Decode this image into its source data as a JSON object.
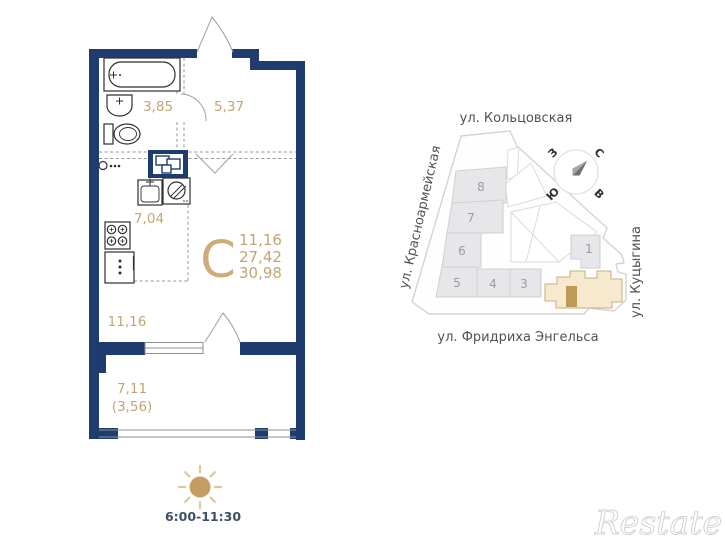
{
  "floor_plan": {
    "unit_letter": "С",
    "stats": [
      "11,16",
      "27,42",
      "30,98"
    ],
    "labels": {
      "bathroom": "3,85",
      "hall": "5,37",
      "kitchen": "7,04",
      "living": "11,16",
      "balcony": "7,11",
      "balcony_reduced": "(3,56)"
    }
  },
  "site_plan": {
    "streets": {
      "top": "ул. Кольцовская",
      "left": "ул. Красноармейская",
      "right": "ул. Куцыгина",
      "bottom": "ул. Фридриха Энгельса"
    },
    "compass": {
      "north": "С",
      "south": "Ю",
      "west": "З",
      "east": "В"
    },
    "building_numbers": [
      "8",
      "7",
      "6",
      "5",
      "4",
      "3",
      "1"
    ]
  },
  "insolation": {
    "time_range": "6:00-11:30"
  },
  "watermark": {
    "text": "Restate"
  },
  "colors": {
    "wall": "#1e3c6d",
    "accent": "#c4a471",
    "big_letter": "#ccad7a",
    "fixture": "#2f2f33",
    "dash": "#8f959d",
    "building_fill": "#e7e7ea",
    "building_stroke": "#cfcfd4",
    "building_number": "#9b9ba1",
    "street_text": "#515157",
    "highlight_fill": "#f6e9cd",
    "highlight_stroke": "#c9ae7c",
    "marker": "#c09a55",
    "sun_fill": "#c49d62",
    "sun_rays": "#ddc79c",
    "time_text": "#3f5068"
  }
}
